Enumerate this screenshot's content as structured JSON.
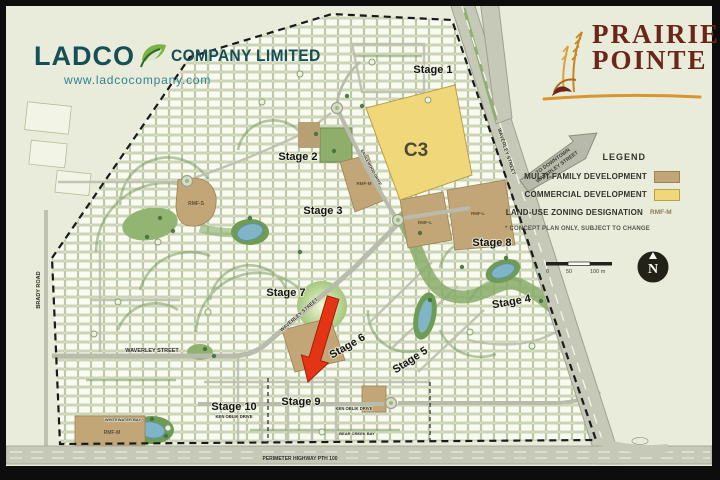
{
  "branding": {
    "ladco": {
      "name": "LADCO",
      "suffix": "COMPANY LIMITED",
      "url": "www.ladcocompany.com"
    },
    "prairie_pointe": {
      "line1": "PRAIRIE",
      "line2": "POINTE"
    }
  },
  "legend": {
    "title": "LEGEND",
    "items": [
      {
        "label": "MULTI-FAMILY DEVELOPMENT",
        "color": "#c2a678"
      },
      {
        "label": "COMMERCIAL DEVELOPMENT",
        "color": "#f0d779"
      },
      {
        "label": "LAND-USE ZONING DESIGNATION",
        "value": "RMF-M"
      }
    ],
    "note": "* CONCEPT PLAN ONLY, SUBJECT TO CHANGE",
    "scale": {
      "ticks": [
        "0",
        "50",
        "100 m"
      ]
    },
    "compass": "N"
  },
  "direction_arrow": {
    "line1": "TO DOWNTOWN",
    "line2": "WAVERLEY STREET"
  },
  "map": {
    "c3_label": "C3",
    "stages": [
      {
        "label": "Stage 1"
      },
      {
        "label": "Stage 2"
      },
      {
        "label": "Stage 3"
      },
      {
        "label": "Stage 4"
      },
      {
        "label": "Stage 5"
      },
      {
        "label": "Stage 6"
      },
      {
        "label": "Stage 7"
      },
      {
        "label": "Stage 8"
      },
      {
        "label": "Stage 9"
      },
      {
        "label": "Stage 10"
      }
    ],
    "zoning": [
      {
        "label": "RMF-S"
      },
      {
        "label": "RMF-M"
      },
      {
        "label": "RMF-L"
      },
      {
        "label": "RMF-L"
      },
      {
        "label": "RMF-M"
      }
    ],
    "streets": {
      "waverley": "WAVERLEY STREET",
      "brady": "BRADY ROAD",
      "perimeter": "PERIMETER HIGHWAY PTH 100",
      "ken_oblik": "KEN OBLIK DRIVE",
      "bear_creek": "BEAR CREEK BAY",
      "whitewater": "WHITEWATER BAY",
      "eaglewood": "EAGLEWOOD DRIVE"
    }
  },
  "colors": {
    "multi_family": "#c2a678",
    "commercial": "#f0d779",
    "arrow_red": "#e33414",
    "ladco_teal": "#174f57",
    "prairie_maroon": "#6b2619",
    "wheat_orange": "#d4912c"
  }
}
